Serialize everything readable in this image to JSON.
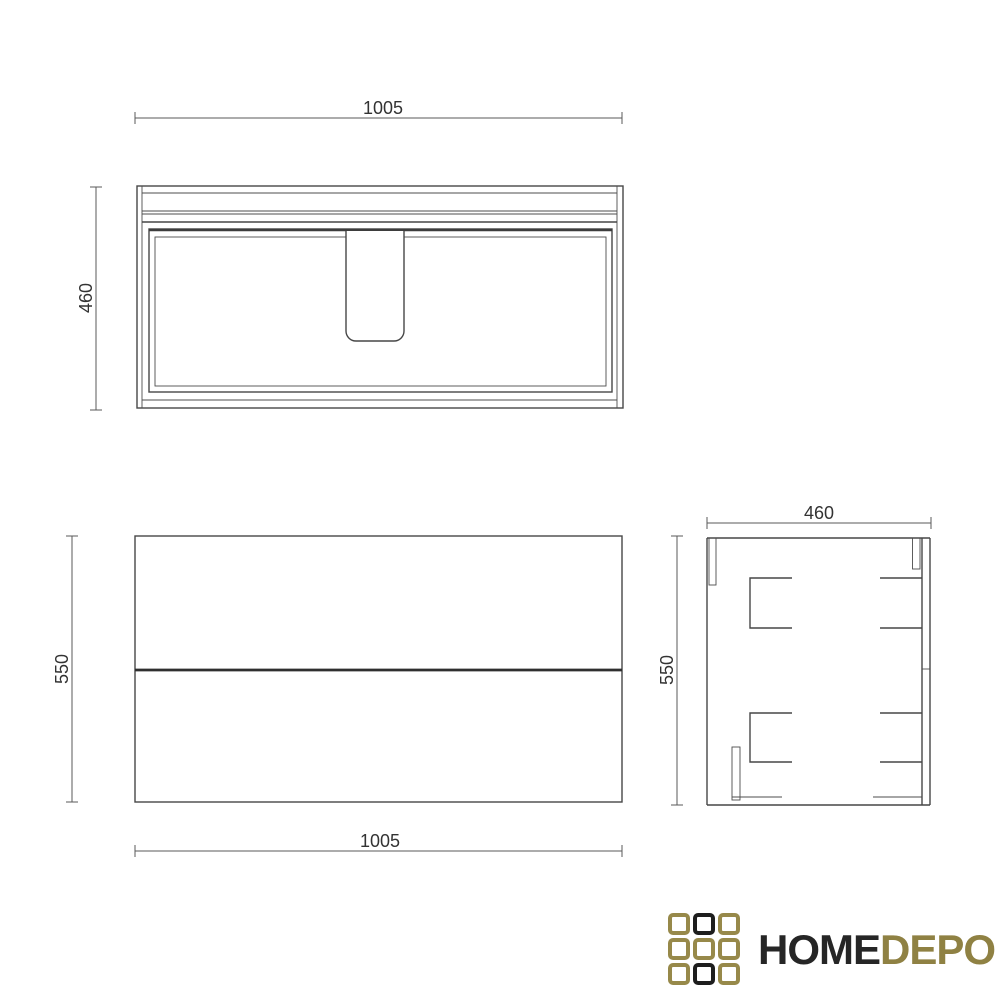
{
  "dimensions": {
    "top_width": "1005",
    "top_depth": "460",
    "front_width": "1005",
    "front_height": "550",
    "side_depth": "460",
    "side_height": "550"
  },
  "logo": {
    "text_primary": "HOME",
    "text_secondary": "DEPO",
    "colors": {
      "gold": "#97894a",
      "black": "#1e1e1e",
      "text_primary": "#262626",
      "text_secondary": "#8f8143"
    },
    "grid_pattern": [
      [
        "gold",
        "black",
        "gold"
      ],
      [
        "gold",
        "gold",
        "gold"
      ],
      [
        "gold",
        "black",
        "gold"
      ]
    ]
  },
  "drawing": {
    "line_color": "#474747",
    "dim_line_color": "#5a5a5a",
    "dim_text_color": "#333333",
    "background": "#ffffff"
  }
}
